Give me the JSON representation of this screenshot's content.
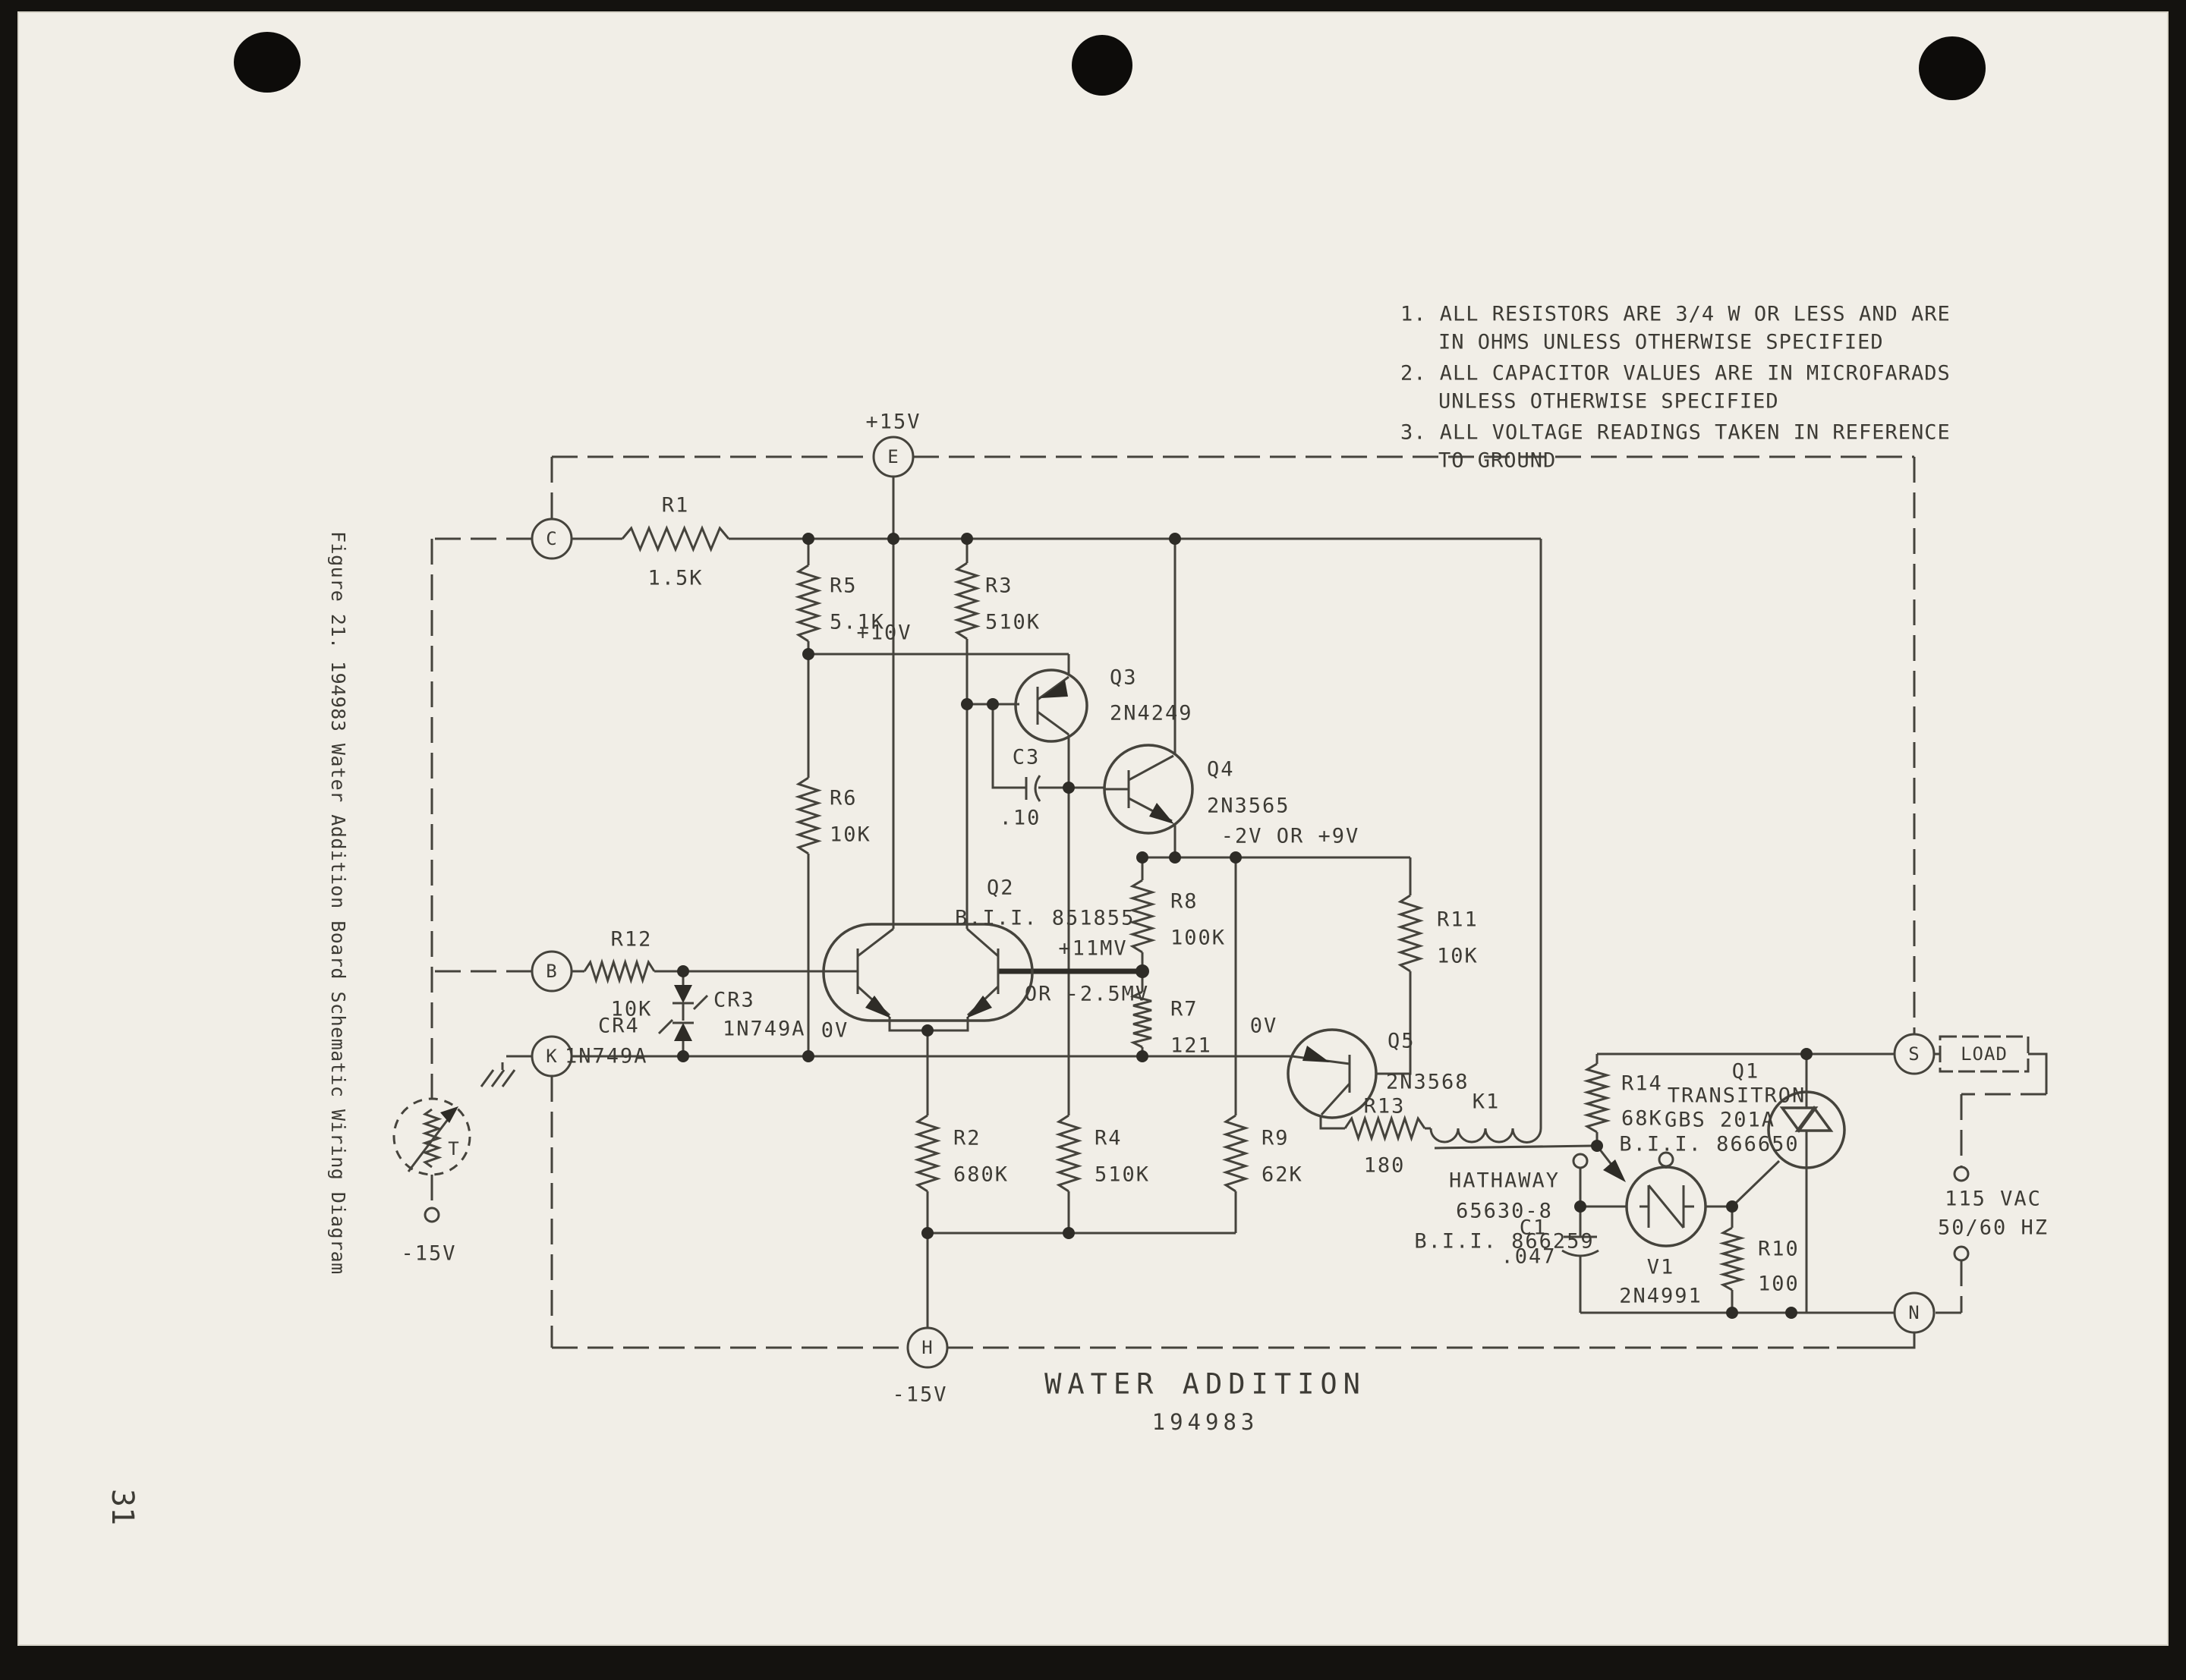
{
  "page": {
    "number": "31",
    "caption": "Figure 21.  194983 Water Addition Board Schematic Wiring Diagram"
  },
  "notes": {
    "lines": [
      "1. ALL RESISTORS ARE 3/4 W OR LESS AND ARE",
      "IN OHMS UNLESS OTHERWISE SPECIFIED",
      "2. ALL CAPACITOR VALUES ARE IN MICROFARADS",
      "UNLESS OTHERWISE SPECIFIED",
      "3. ALL VOLTAGE READINGS TAKEN IN REFERENCE",
      "TO GROUND"
    ]
  },
  "title": {
    "line1": "WATER ADDITION",
    "line2": "194983"
  },
  "terminals": {
    "e": "E",
    "c": "C",
    "b": "B",
    "k": "K",
    "h": "H",
    "s": "S",
    "n": "N",
    "t": "T",
    "load": "LOAD"
  },
  "voltages": {
    "p15": "+15V",
    "p10": "+10V",
    "n15_probe": "-15V",
    "n15_h": "-15V",
    "ov_left": "0V",
    "ov_right": "0V",
    "p11mv": "+11MV",
    "or_n25mv": "OR -2.5MV",
    "n2_or_p9": "-2V OR +9V",
    "vac": "115 VAC",
    "hz": "50/60 HZ"
  },
  "components": {
    "r1": {
      "ref": "R1",
      "value": "1.5K"
    },
    "r2": {
      "ref": "R2",
      "value": "680K"
    },
    "r3": {
      "ref": "R3",
      "value": "510K"
    },
    "r4": {
      "ref": "R4",
      "value": "510K"
    },
    "r5": {
      "ref": "R5",
      "value": "5.1K"
    },
    "r6": {
      "ref": "R6",
      "value": "10K"
    },
    "r7": {
      "ref": "R7",
      "value": "121"
    },
    "r8": {
      "ref": "R8",
      "value": "100K"
    },
    "r9": {
      "ref": "R9",
      "value": "62K"
    },
    "r10": {
      "ref": "R10",
      "value": "100"
    },
    "r11": {
      "ref": "R11",
      "value": "10K"
    },
    "r12": {
      "ref": "R12",
      "value": "10K"
    },
    "r13": {
      "ref": "R13",
      "value": "180"
    },
    "r14": {
      "ref": "R14",
      "value": "68K"
    },
    "c1": {
      "ref": "C1",
      "value": ".047"
    },
    "c3": {
      "ref": "C3",
      "value": ".10"
    },
    "cr3": {
      "ref": "CR3",
      "value": "1N749A"
    },
    "cr4": {
      "ref": "CR4",
      "value": "1N749A"
    },
    "q1": {
      "ref": "Q1",
      "maker": "TRANSITRON",
      "value": "GBS 201A",
      "bii": "B.I.I. 866650"
    },
    "q2": {
      "ref": "Q2",
      "value": "B.I.I. 851855"
    },
    "q3": {
      "ref": "Q3",
      "value": "2N4249"
    },
    "q4": {
      "ref": "Q4",
      "value": "2N3565"
    },
    "q5": {
      "ref": "Q5",
      "value": "2N3568"
    },
    "v1": {
      "ref": "V1",
      "value": "2N4991"
    },
    "k1": {
      "ref": "K1",
      "maker": "HATHAWAY",
      "value": "65630-8",
      "bii": "B.I.I. 866259"
    }
  }
}
